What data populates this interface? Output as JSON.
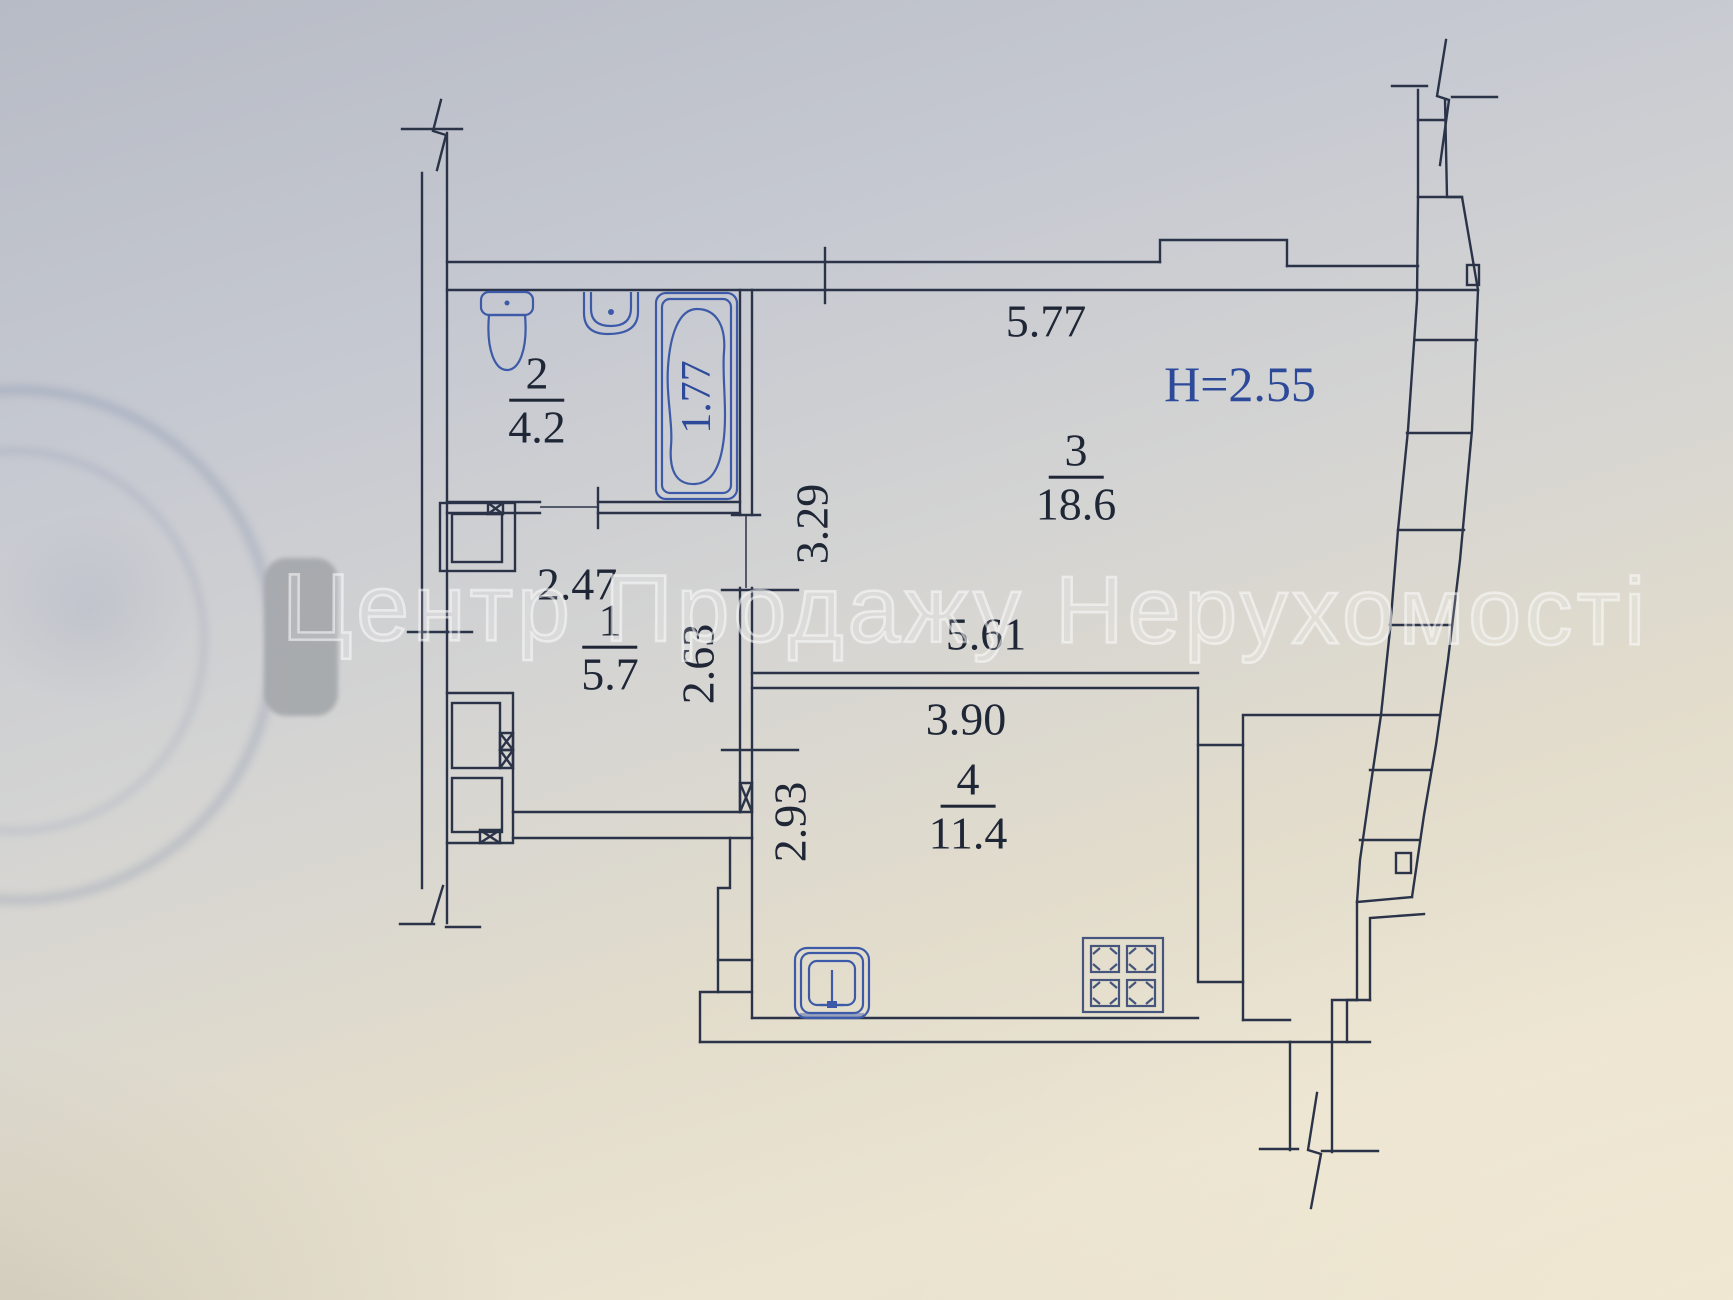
{
  "watermark": {
    "text": "Центр Продажу Нерухомості"
  },
  "plan": {
    "ceiling_height": "Н=2.55",
    "rooms": [
      {
        "number": "1",
        "area": "5.7"
      },
      {
        "number": "2",
        "area": "4.2"
      },
      {
        "number": "3",
        "area": "18.6"
      },
      {
        "number": "4",
        "area": "11.4"
      }
    ],
    "dimensions": {
      "room3_top_width": "5.77",
      "tub_length": "1.77",
      "room3_depth": "3.29",
      "hall_width": "2.47",
      "hall_depth": "2.63",
      "room3_bottom_width": "5.61",
      "kitchen_width": "3.90",
      "kitchen_depth": "2.93"
    }
  },
  "colors": {
    "ink": "#2b3348",
    "fixture_blue": "#3c5aa8",
    "accent_blue": "#2d4a9a",
    "stove_blue": "#46557c",
    "label_dark": "#1f2636",
    "watermark_stroke": "rgba(252,252,252,0.55)",
    "redaction_gray": "#a6a9ad",
    "stamp_blue": "rgba(90,108,150,0.2)"
  }
}
